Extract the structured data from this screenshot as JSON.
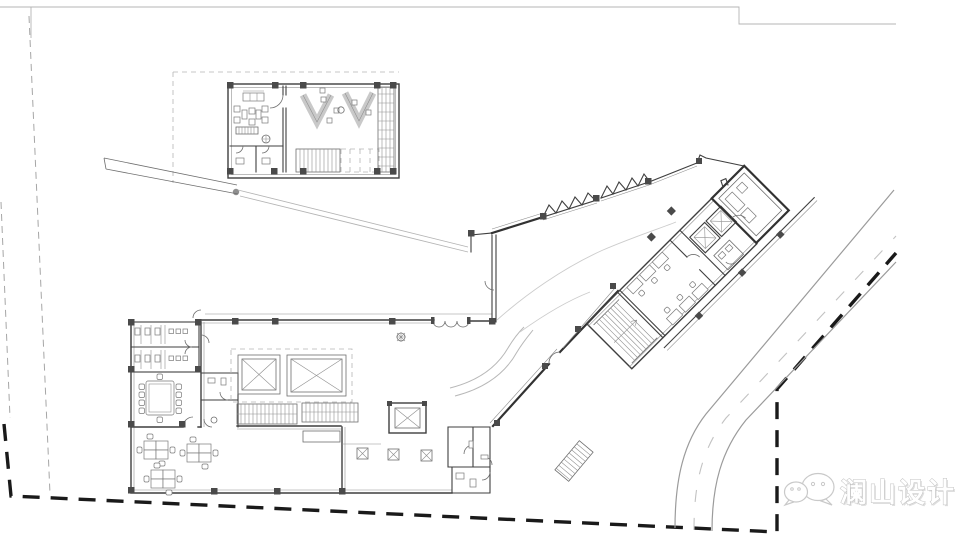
{
  "watermark": {
    "brand_name": "澜山设计",
    "logo": "wechat-bubbles-icon"
  },
  "palette": {
    "background": "#ffffff",
    "plan_line": "#3f3f3f",
    "thick_wall": "#323232",
    "column_fill": "#4a4a4a",
    "light_line": "#b4b4b4",
    "boundary_dash": "#1a1a1a",
    "setback_dash": "#a6a6a6",
    "road_line": "#9b9b9b",
    "watermark_outline": "#c2c2c2"
  },
  "drawing": {
    "type": "architectural-ground-floor-site-plan",
    "elements": [
      "sheet-border",
      "site-boundary",
      "road",
      "entrance-pavilion",
      "connecting-walkway",
      "main-hall-block",
      "office-wing",
      "rooftop-room",
      "landscape",
      "watermark"
    ]
  }
}
